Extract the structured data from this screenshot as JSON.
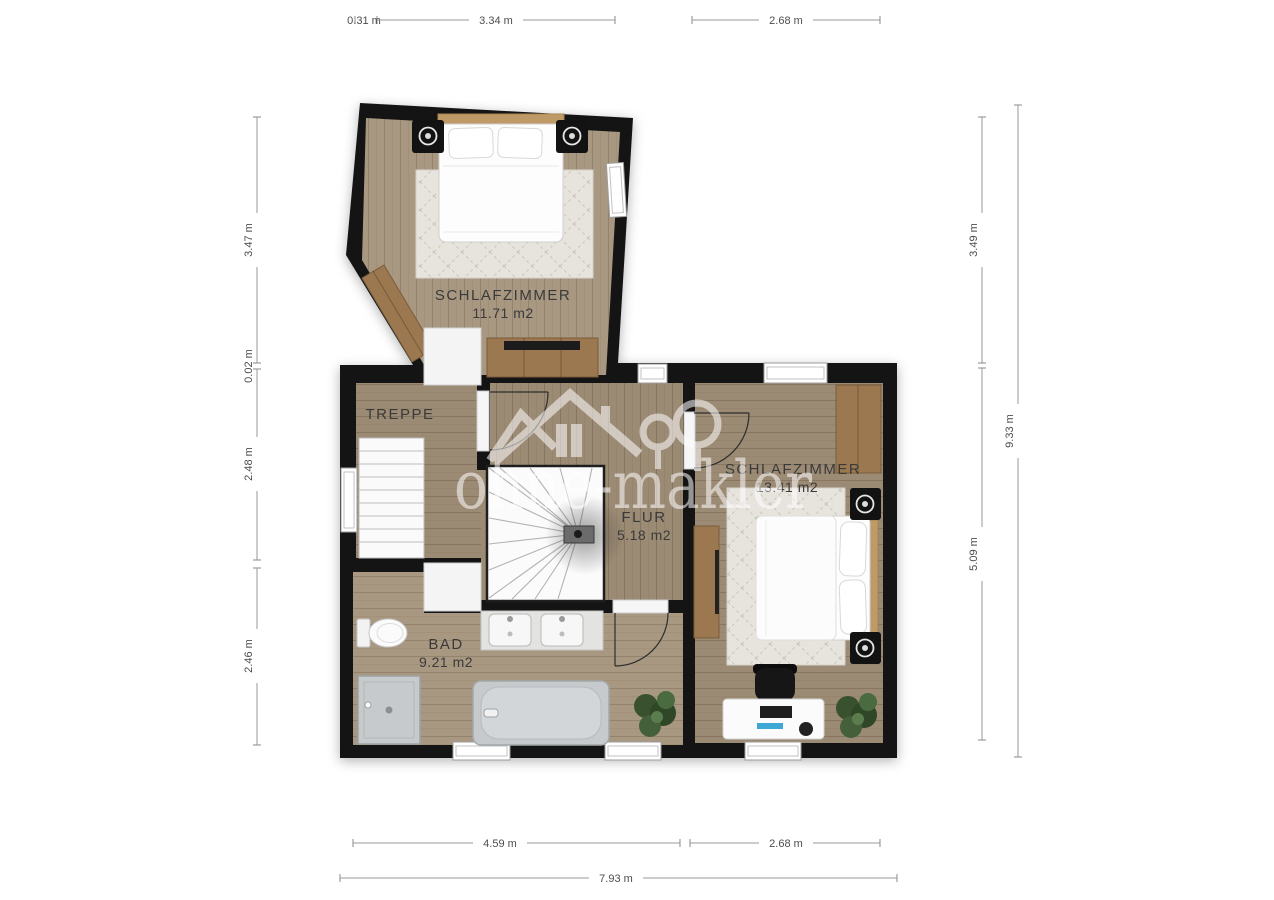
{
  "watermark": {
    "text": "ohne-makler"
  },
  "rooms": {
    "bedroom1": {
      "label": "SCHLAFZIMMER",
      "area": "11.71 m2"
    },
    "treppe": {
      "label": "TREPPE"
    },
    "flur": {
      "label": "FLUR",
      "area": "5.18 m2"
    },
    "bad": {
      "label": "BAD",
      "area": "9.21 m2"
    },
    "bedroom2": {
      "label": "SCHLAFZIMMER",
      "area": "13.41 m2"
    }
  },
  "dimensions": {
    "top": [
      "0.31 m",
      "3.34 m",
      "2.68 m"
    ],
    "left": [
      "3.47 m",
      "0.02 m",
      "2.48 m",
      "2.46 m"
    ],
    "right": [
      "3.49 m",
      "5.09 m",
      "9.33 m"
    ],
    "bottom": [
      "4.59 m",
      "2.68 m",
      "7.93 m"
    ]
  },
  "colors": {
    "wall": "#141414",
    "floor_light": "#a99881",
    "floor_dark": "#9c8b74",
    "rug": "#e7e4de",
    "fixture_gray": "#c6cacc",
    "wood_furniture": "#9b7850",
    "plant_green": "#3d5a31",
    "dimension_text": "#4d4d4d",
    "watermark_white": "#ffffff"
  }
}
